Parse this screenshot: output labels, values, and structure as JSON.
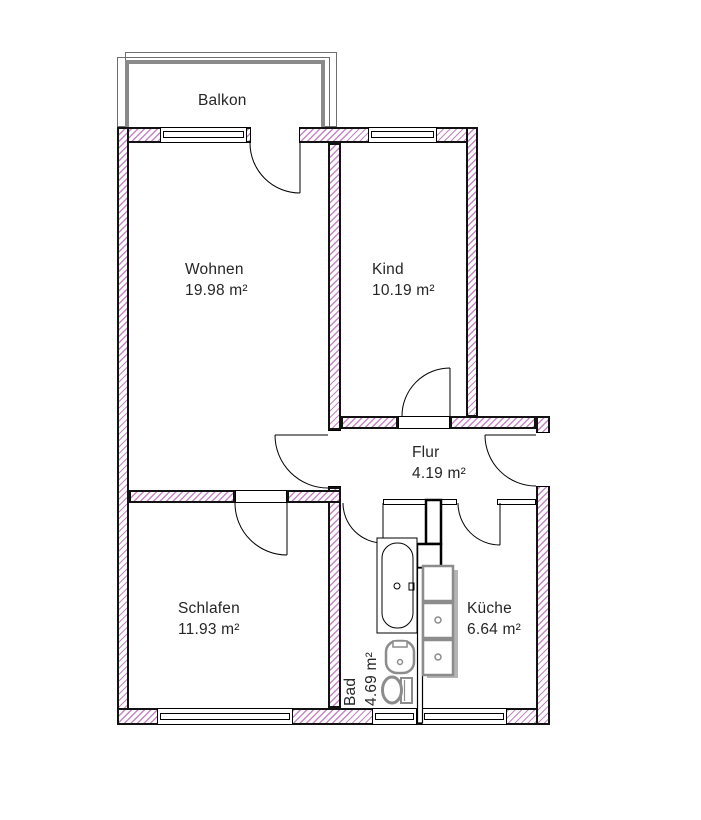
{
  "plan": {
    "balcony": {
      "label": "Balkon"
    },
    "rooms": [
      {
        "id": "wohnen",
        "name": "Wohnen",
        "area": "19.98 m²"
      },
      {
        "id": "kind",
        "name": "Kind",
        "area": "10.19 m²"
      },
      {
        "id": "flur",
        "name": "Flur",
        "area": "4.19 m²"
      },
      {
        "id": "schlafen",
        "name": "Schlafen",
        "area": "11.93 m²"
      },
      {
        "id": "bad",
        "name": "Bad",
        "area": "4.69 m²"
      },
      {
        "id": "kueche",
        "name": "Küche",
        "area": "6.64 m²"
      }
    ],
    "fixtures": [
      "bathtub",
      "washbasin",
      "toilet",
      "kitchen-sink-unit"
    ],
    "colors": {
      "wall_hatch": "#c487c4",
      "wall_outline": "#121212",
      "balcony_railing": "#8a8a8a",
      "fixture_gray": "#8c8c8c",
      "text": "#262626",
      "background": "#ffffff"
    }
  }
}
